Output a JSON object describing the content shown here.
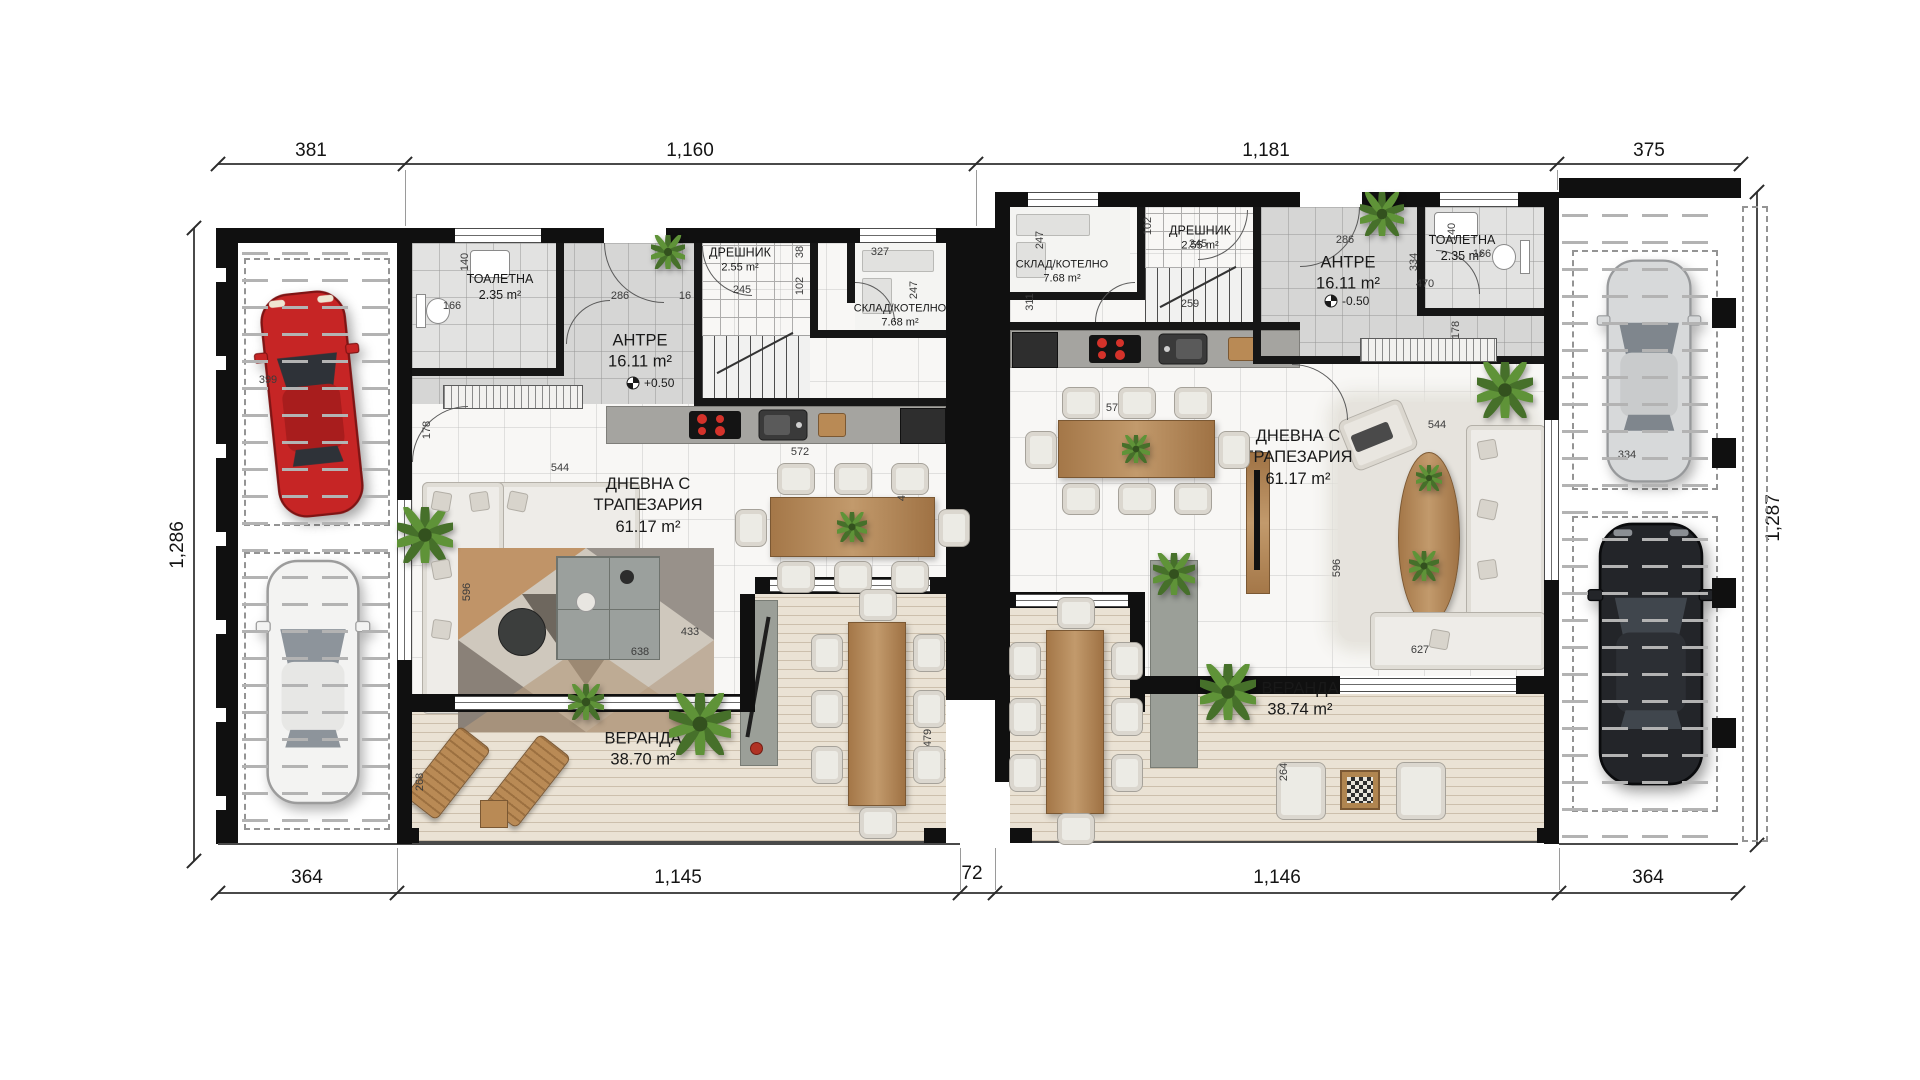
{
  "plan": {
    "dims": {
      "top": [
        "381",
        "1,160",
        "1,181",
        "375"
      ],
      "bottom": [
        "364",
        "1,145",
        "72",
        "1,146",
        "364"
      ],
      "left": "1,286",
      "right": "1,287"
    },
    "units": {
      "left": {
        "toilet_name": "ТОАЛЕТНА",
        "toilet_area": "2.35 m²",
        "entry_name": "АНТРЕ",
        "entry_area": "16.11 m²",
        "entry_level": "+0.50",
        "closet_name": "ДРЕШНИК",
        "closet_area": "2.55 m²",
        "storage_name": "СКЛАД/КОТЕЛНО",
        "storage_area": "7.68 m²",
        "living_name1": "ДНЕВНА С",
        "living_name2": "ТРАПЕЗАРИЯ",
        "living_area": "61.17 m²",
        "veranda_name": "ВЕРАНДА",
        "veranda_area": "38.70 m²"
      },
      "right": {
        "toilet_name": "ТОАЛЕТНА",
        "toilet_area": "2.35 m²",
        "entry_name": "АНТРЕ",
        "entry_area": "16.11 m²",
        "entry_level": "-0.50",
        "closet_name": "ДРЕШНИК",
        "closet_area": "2.55 m²",
        "storage_name": "СКЛАД/КОТЕЛНО",
        "storage_area": "7.68 m²",
        "living_name1": "ДНЕВНА С",
        "living_name2": "ТРАПЕЗАРИЯ",
        "living_area": "61.17 m²",
        "veranda_name": "ВЕРАНДА",
        "veranda_area": "38.74 m²"
      }
    },
    "inner_dims": [
      {
        "t": "140",
        "x": 465,
        "y": 262,
        "r": 1
      },
      {
        "t": "166",
        "x": 452,
        "y": 306,
        "r": 0
      },
      {
        "t": "286",
        "x": 620,
        "y": 296,
        "r": 0
      },
      {
        "t": "16",
        "x": 685,
        "y": 296,
        "r": 0
      },
      {
        "t": "245",
        "x": 742,
        "y": 290,
        "r": 0
      },
      {
        "t": "38",
        "x": 800,
        "y": 252,
        "r": 1
      },
      {
        "t": "102",
        "x": 800,
        "y": 286,
        "r": 1
      },
      {
        "t": "178",
        "x": 427,
        "y": 430,
        "r": 1
      },
      {
        "t": "327",
        "x": 880,
        "y": 252,
        "r": 0
      },
      {
        "t": "247",
        "x": 914,
        "y": 290,
        "r": 1
      },
      {
        "t": "544",
        "x": 560,
        "y": 468,
        "r": 0
      },
      {
        "t": "572",
        "x": 800,
        "y": 452,
        "r": 0
      },
      {
        "t": "488",
        "x": 902,
        "y": 492,
        "r": 1
      },
      {
        "t": "596",
        "x": 467,
        "y": 592,
        "r": 1
      },
      {
        "t": "638",
        "x": 640,
        "y": 652,
        "r": 0
      },
      {
        "t": "433",
        "x": 690,
        "y": 632,
        "r": 0
      },
      {
        "t": "479",
        "x": 928,
        "y": 738,
        "r": 1
      },
      {
        "t": "268",
        "x": 420,
        "y": 782,
        "r": 1
      },
      {
        "t": "399",
        "x": 268,
        "y": 380,
        "r": 0
      },
      {
        "t": "247",
        "x": 1040,
        "y": 240,
        "r": 1
      },
      {
        "t": "311",
        "x": 1030,
        "y": 302,
        "r": 1
      },
      {
        "t": "102",
        "x": 1148,
        "y": 226,
        "r": 1
      },
      {
        "t": "245",
        "x": 1198,
        "y": 244,
        "r": 0
      },
      {
        "t": "259",
        "x": 1190,
        "y": 304,
        "r": 0
      },
      {
        "t": "286",
        "x": 1345,
        "y": 240,
        "r": 0
      },
      {
        "t": "334",
        "x": 1414,
        "y": 262,
        "r": 1
      },
      {
        "t": "140",
        "x": 1452,
        "y": 232,
        "r": 1
      },
      {
        "t": "166",
        "x": 1482,
        "y": 254,
        "r": 0
      },
      {
        "t": "470",
        "x": 1425,
        "y": 284,
        "r": 0
      },
      {
        "t": "178",
        "x": 1456,
        "y": 330,
        "r": 1
      },
      {
        "t": "468",
        "x": 1046,
        "y": 440,
        "r": 1
      },
      {
        "t": "572",
        "x": 1115,
        "y": 408,
        "r": 0
      },
      {
        "t": "544",
        "x": 1437,
        "y": 425,
        "r": 0
      },
      {
        "t": "596",
        "x": 1337,
        "y": 568,
        "r": 1
      },
      {
        "t": "627",
        "x": 1420,
        "y": 650,
        "r": 0
      },
      {
        "t": "264",
        "x": 1284,
        "y": 772,
        "r": 1
      },
      {
        "t": "334",
        "x": 1627,
        "y": 455,
        "r": 0
      }
    ],
    "levels": [
      {
        "t": "+0.50",
        "x": 656,
        "y": 384
      },
      {
        "t": "-0.50",
        "x": 1354,
        "y": 302
      }
    ]
  },
  "colors": {
    "wall": "#101010",
    "red_car": "#c62525",
    "white_car": "#f3f3f2",
    "silver_car": "#d7d9da",
    "black_car": "#232529",
    "deck": "#eae2d4",
    "tile": "#d6d6d5",
    "burner": "#d4322a",
    "wood": "#a97d50",
    "plant_dark": "#46702a",
    "plant_light": "#5f9338"
  }
}
